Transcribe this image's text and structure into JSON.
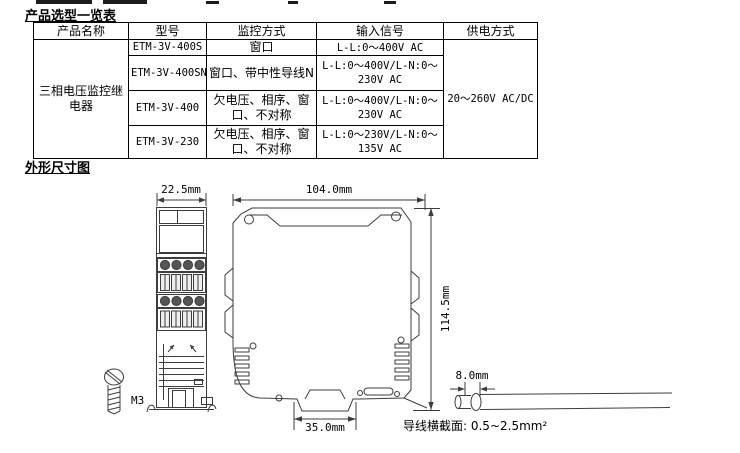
{
  "sections": {
    "selection_title": "产品选型一览表",
    "dimensions_title": "外形尺寸图"
  },
  "table": {
    "headers": [
      "产品名称",
      "型号",
      "监控方式",
      "输入信号",
      "供电方式"
    ],
    "product_name": "三相电压监控继电器",
    "power_supply": "20～260V AC/DC",
    "rows": [
      {
        "model": "ETM-3V-400S",
        "monitor": "窗口",
        "input": "L-L:0～400V AC"
      },
      {
        "model": "ETM-3V-400SN",
        "monitor": "窗口、带中性导线N",
        "input": "L-L:0～400V/L-N:0～230V AC"
      },
      {
        "model": "ETM-3V-400",
        "monitor": "欠电压、相序、窗口、不对称",
        "input": "L-L:0～400V/L-N:0～230V AC"
      },
      {
        "model": "ETM-3V-230",
        "monitor": "欠电压、相序、窗口、不对称",
        "input": "L-L:0～230V/L-N:0～135V AC"
      }
    ]
  },
  "diagram": {
    "front_width": "22.5mm",
    "side_width": "104.0mm",
    "side_height": "114.5mm",
    "rail_notch_width": "35.0mm",
    "wire_strip_length": "8.0mm",
    "screw_label": "M3",
    "wire_note": "导线横截面: 0.5~2.5mm²",
    "line_color": "#3d3d3d"
  }
}
